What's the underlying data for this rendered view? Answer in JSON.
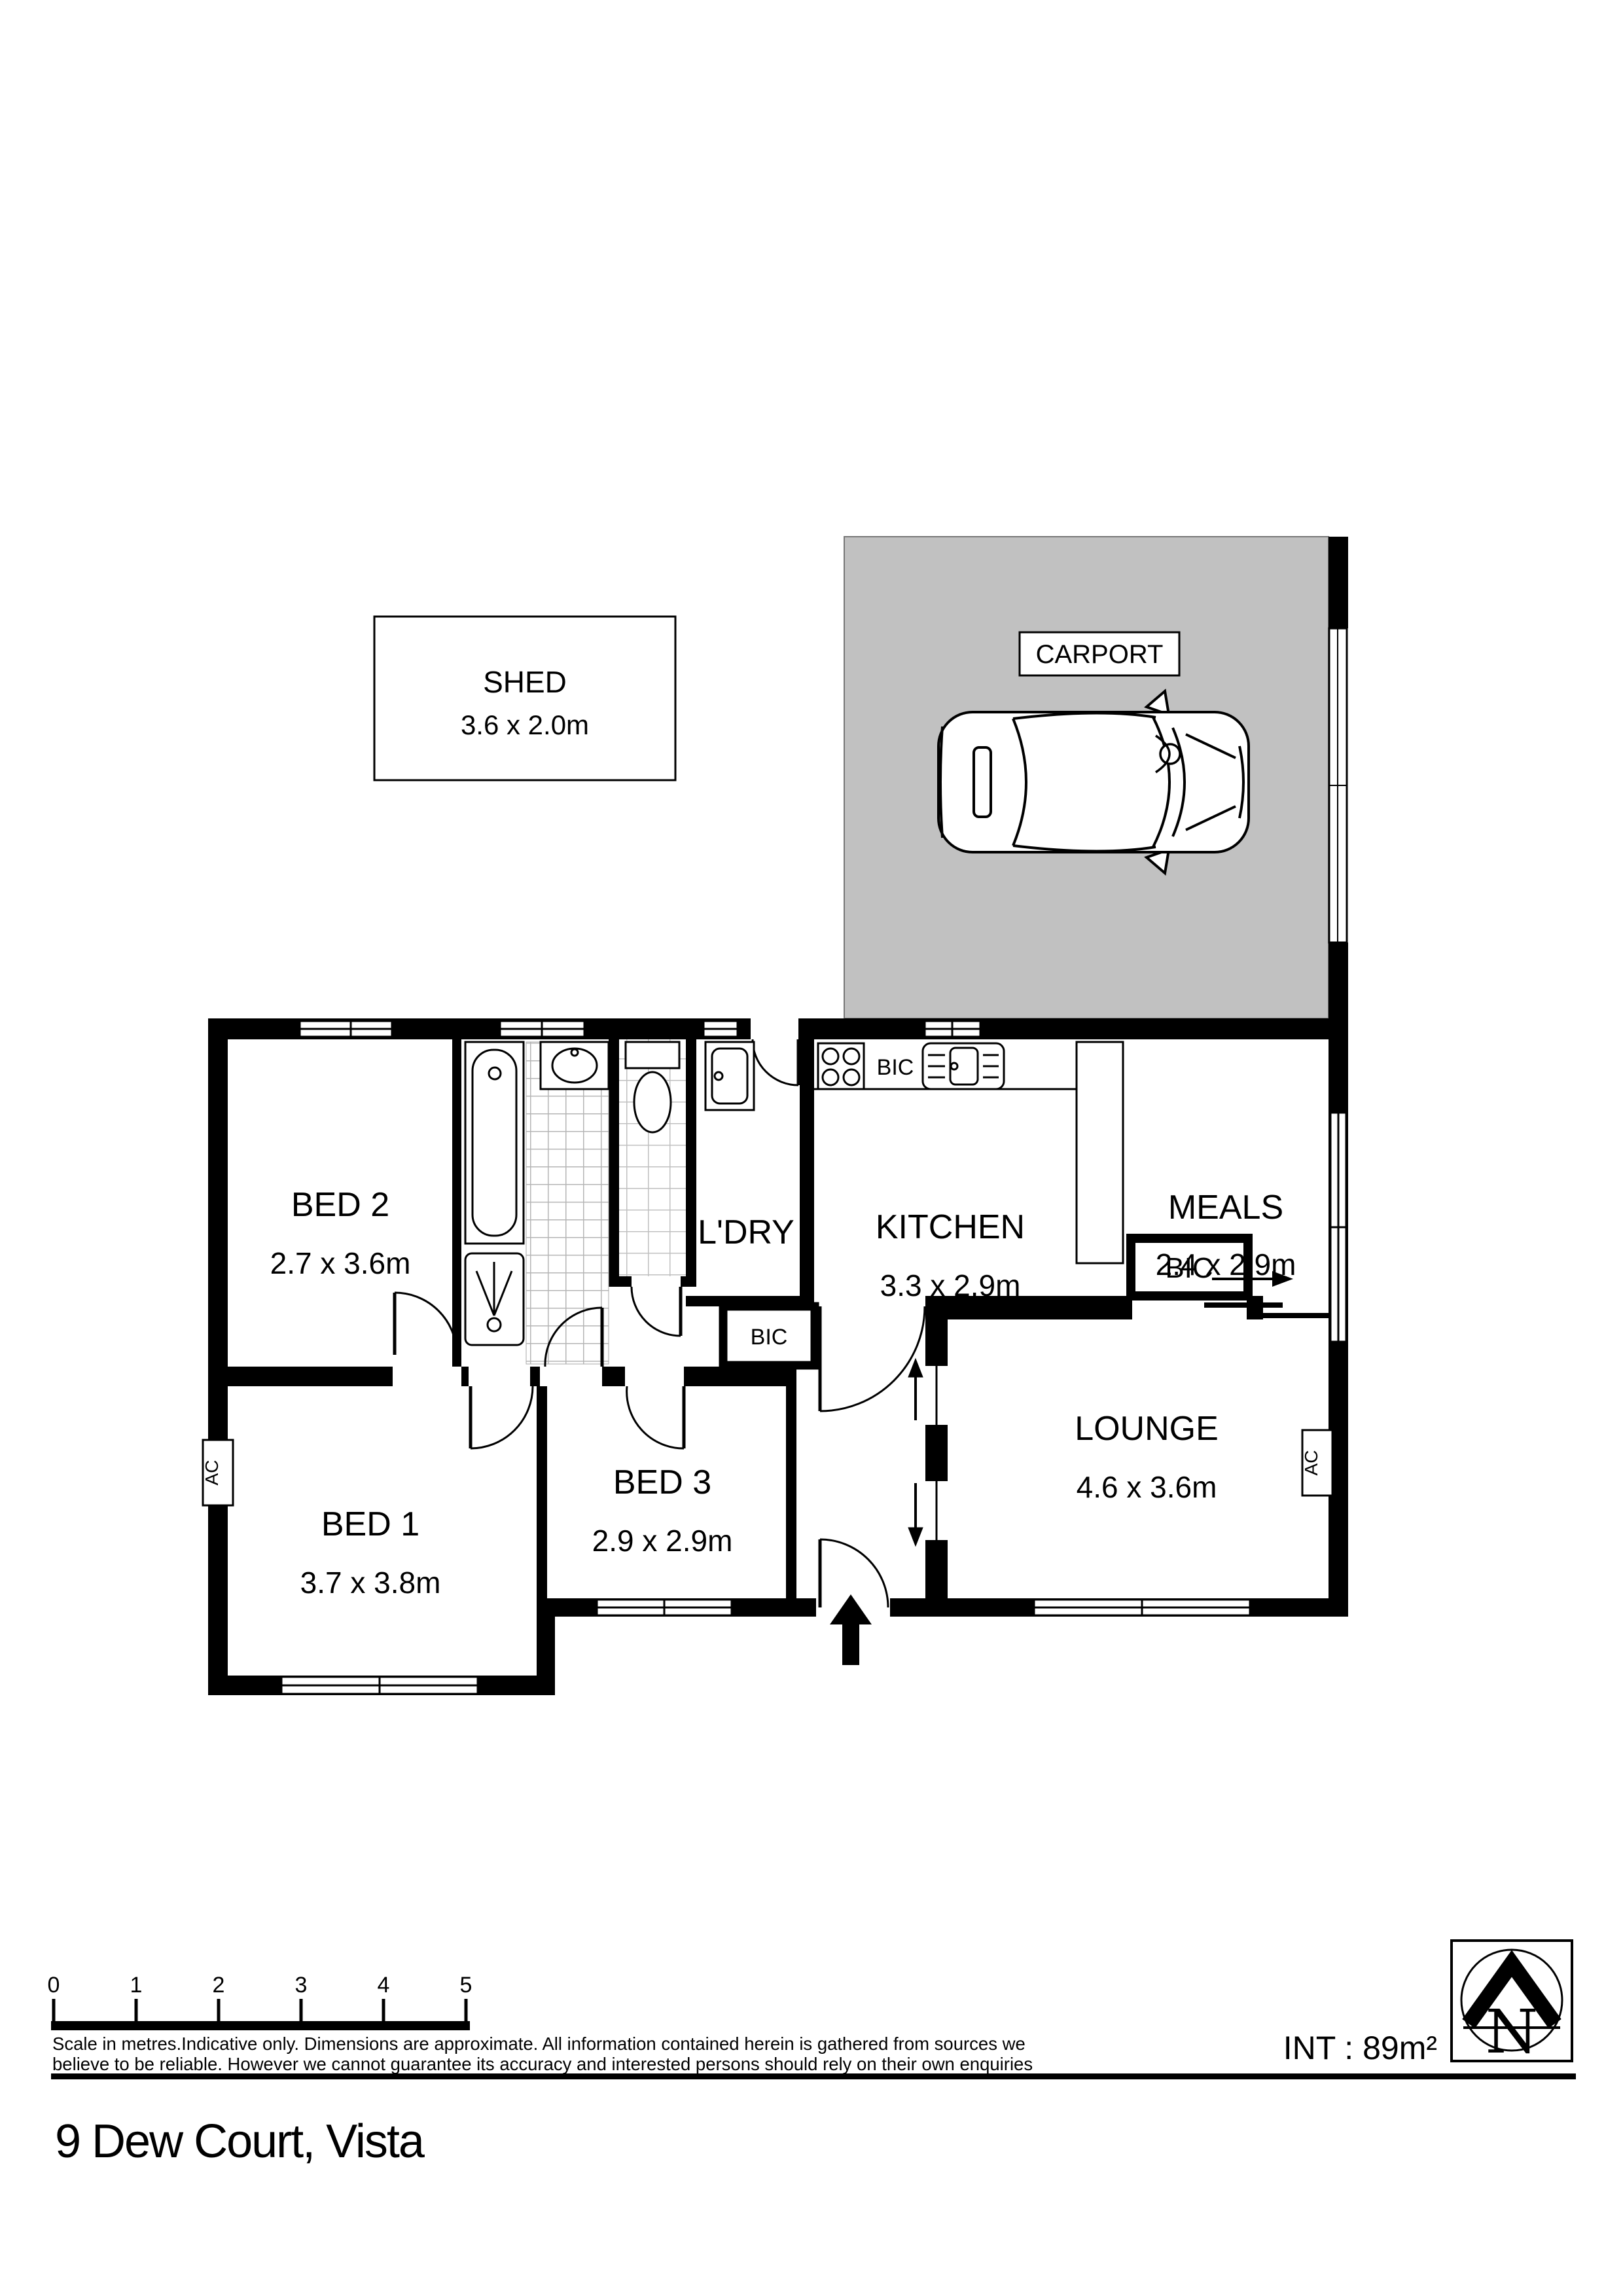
{
  "title": "9 Dew Court, Vista",
  "shed": {
    "label": "SHED",
    "dims": "3.6 x 2.0m"
  },
  "carport": {
    "label": "CARPORT"
  },
  "rooms": {
    "bed2": {
      "label": "BED 2",
      "dims": "2.7 x 3.6m"
    },
    "bed1": {
      "label": "BED 1",
      "dims": "3.7 x 3.8m"
    },
    "bed3": {
      "label": "BED 3",
      "dims": "2.9 x 2.9m"
    },
    "ldry": {
      "label": "L'DRY"
    },
    "kitchen": {
      "label": "KITCHEN",
      "dims": "3.3 x 2.9m"
    },
    "meals": {
      "label": "MEALS",
      "dims": "2.4 x 2.9m"
    },
    "lounge": {
      "label": "LOUNGE",
      "dims": "4.6 x 3.6m"
    }
  },
  "cupboards": {
    "kitchen_bench": "BIC",
    "hall": "BIC",
    "lounge": "BIC"
  },
  "ac_units": {
    "bed1": "AC",
    "lounge": "AC"
  },
  "north": {
    "letter": "N"
  },
  "scale_bar": {
    "ticks": [
      "0",
      "1",
      "2",
      "3",
      "4",
      "5"
    ]
  },
  "footer": {
    "disclaimer_line1": "Scale in metres.Indicative only. Dimensions are approximate. All information contained herein is gathered from sources we",
    "disclaimer_line2": "believe to be reliable. However we cannot guarantee its accuracy and interested persons should rely on their own enquiries",
    "int_area": "INT : 89m²"
  }
}
